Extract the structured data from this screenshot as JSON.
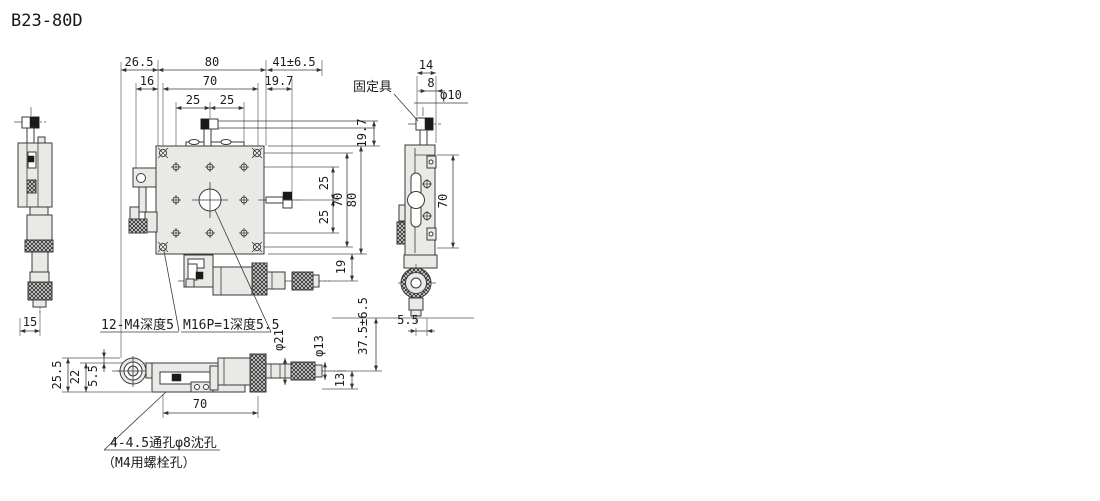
{
  "title": "B23-80D",
  "callouts": {
    "fixture": "固定具",
    "grid_taps": "12-M4深度5",
    "center_tap": "M16P=1深度5.5",
    "base_holes": "4-4.5通孔φ8沈孔",
    "base_holes_note": "（M4用螺栓孔）"
  },
  "dims": {
    "plan": {
      "d26_5": "26.5",
      "d16": "16",
      "d80w": "80",
      "d70w": "70",
      "d25a": "25",
      "d25b": "25",
      "d41": "41±6.5",
      "d19_7a": "19.7",
      "d19_7b": "19.7",
      "d25c": "25",
      "d25d": "25",
      "d70h": "70",
      "d80h": "80",
      "d19": "19",
      "d37_5": "37.5±6.5"
    },
    "right": {
      "d14": "14",
      "d8": "8",
      "dphi10": "φ10",
      "d70": "70",
      "d5_5": "5.5"
    },
    "left": {
      "d15": "15"
    },
    "front": {
      "d25_5": "25.5",
      "d22": "22",
      "d5_5": "5.5",
      "d70": "70",
      "dphi21": "φ21",
      "dphi13": "φ13",
      "d13": "13"
    }
  }
}
